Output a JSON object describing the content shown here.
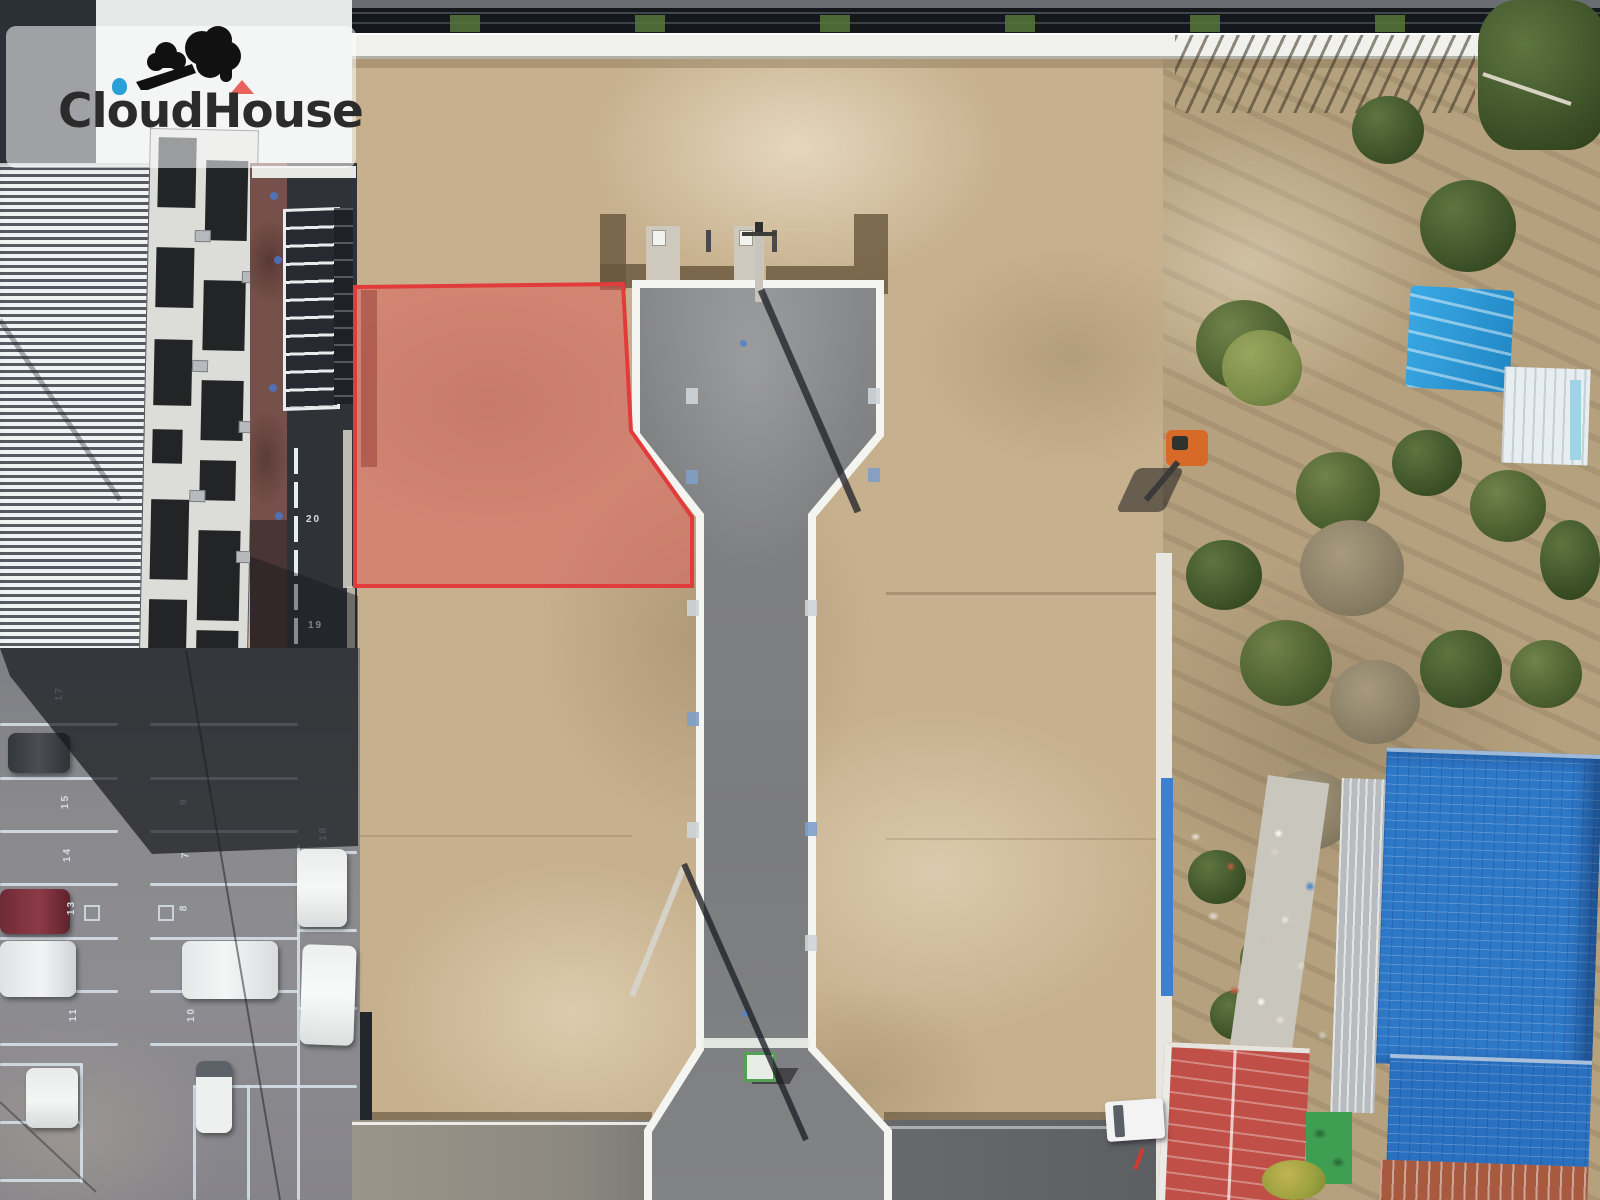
{
  "logo": {
    "brand_first": "Cloud",
    "brand_second": "House",
    "mark": "cloud-with-bird-mark"
  },
  "overlay": {
    "highlight_lot": {
      "points": "355,287 623,284 631,431 692,517 692,586 355,586",
      "inner_strip_points": "361,290 377,290 377,467 361,467",
      "fill": "#dd5a5a",
      "stroke": "#e23b3b"
    }
  },
  "parking": {
    "stall_numbers": [
      {
        "label": "20"
      },
      {
        "label": "19"
      },
      {
        "label": "17"
      },
      {
        "label": "15"
      },
      {
        "label": "14"
      },
      {
        "label": "13"
      },
      {
        "label": "11"
      },
      {
        "label": "9"
      },
      {
        "label": "7"
      },
      {
        "label": "8"
      },
      {
        "label": "10"
      },
      {
        "label": "18"
      }
    ]
  },
  "colors": {
    "lot-fill": "#dd5a5a",
    "lot-stroke": "#e23b3b",
    "logo-text": "#2b2b2b",
    "logo-dot": "#2b9fd8",
    "logo-roof": "#e8635c",
    "tarp-blue": "#2f9ad8",
    "roof-blue": "#2e78c8",
    "shed-red": "#bf4f47"
  }
}
